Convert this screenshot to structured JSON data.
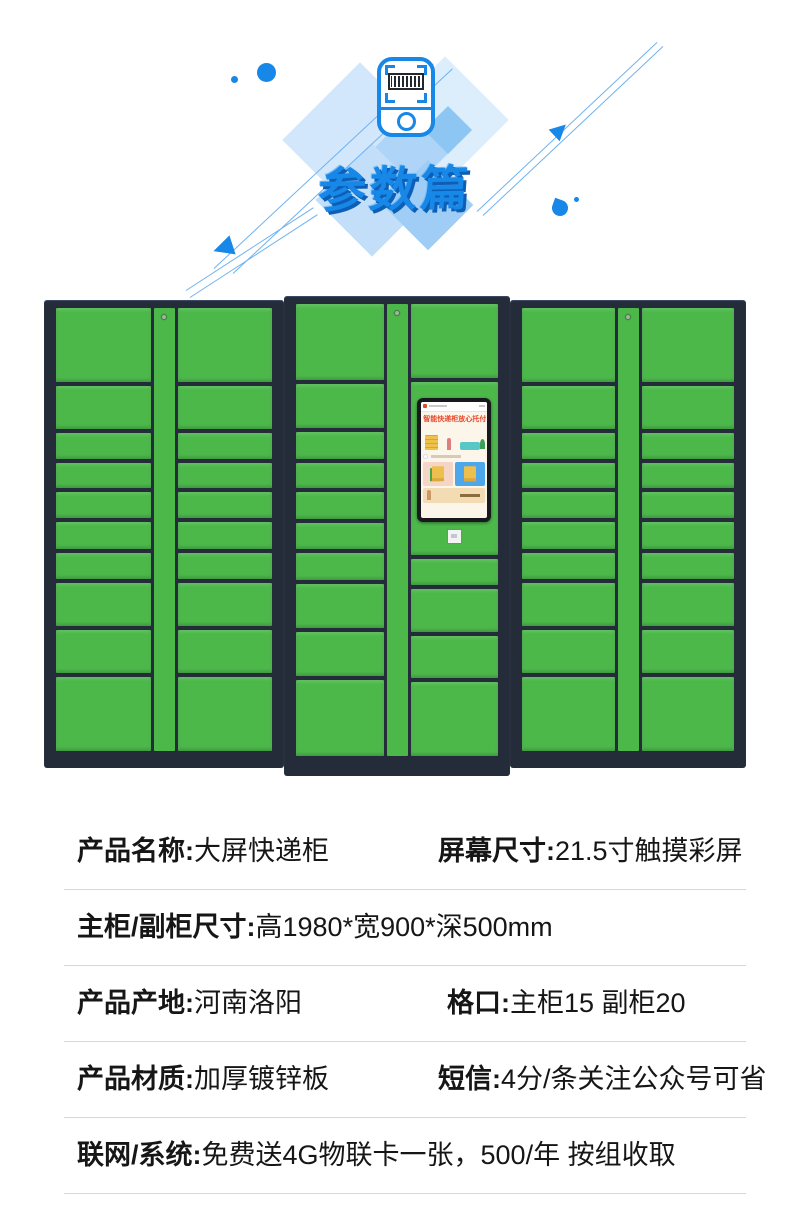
{
  "theme": {
    "accent_blue": "#1787e8",
    "accent_blue_dark": "#0d5fb5",
    "line_blue": "#6fb2f1",
    "door_green": "#4cb84a",
    "frame_dark": "#242b39",
    "divider_gray": "#d8d8d8",
    "text_dark": "#161616"
  },
  "header": {
    "title": "参数篇",
    "icon": "barcode-scanner-icon"
  },
  "lockers": {
    "sub_rows": [
      74,
      43,
      26,
      25,
      26,
      26,
      26,
      43,
      43,
      74
    ],
    "main_left_rows": [
      74,
      43,
      26,
      25,
      26,
      26,
      26,
      43,
      43,
      74
    ],
    "main_right_rows_above_screen": [
      74
    ],
    "main_right_rows_below_screen": [
      26,
      43,
      43,
      74
    ],
    "screen": {
      "title": "智能快递柜放心托付"
    }
  },
  "specs": {
    "rows": [
      {
        "pairs": [
          {
            "label": "产品名称:",
            "value": "大屏快递柜"
          },
          {
            "label": "屏幕尺寸:",
            "value": "21.5寸触摸彩屏"
          }
        ]
      },
      {
        "pairs": [
          {
            "label": "主柜/副柜尺寸:",
            "value": "高1980*宽900*深500mm"
          }
        ]
      },
      {
        "pairs": [
          {
            "label": "产品产地:",
            "value": "河南洛阳"
          },
          {
            "label": "格口:",
            "value": "主柜15 副柜20"
          }
        ]
      },
      {
        "pairs": [
          {
            "label": "产品材质:",
            "value": "加厚镀锌板"
          },
          {
            "label": "短信:",
            "value": "4分/条关注公众号可省"
          }
        ]
      },
      {
        "pairs": [
          {
            "label": "联网/系统:",
            "value": "免费送4G物联卡一张，500/年 按组收取"
          }
        ]
      }
    ]
  }
}
